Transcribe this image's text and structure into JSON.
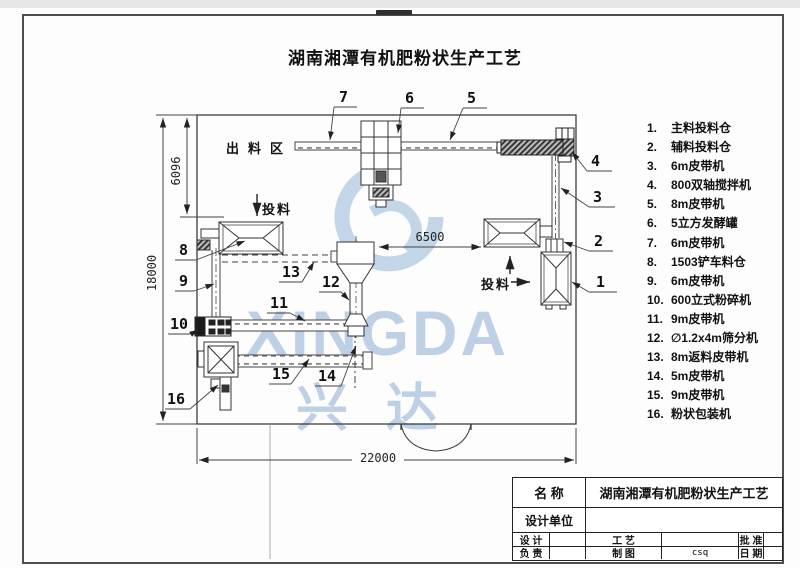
{
  "page": {
    "title": "湖南湘潭有机肥粉状生产工艺"
  },
  "drawing": {
    "area_label": "出料区",
    "feed_label_left": "投料",
    "feed_label_right": "投料",
    "dim_height_total": "18000",
    "dim_height_upper": "6096",
    "dim_width_total": "22000",
    "dim_mid_span": "6500",
    "callouts": [
      "1",
      "2",
      "3",
      "4",
      "5",
      "6",
      "7",
      "8",
      "9",
      "10",
      "11",
      "12",
      "13",
      "14",
      "15",
      "16"
    ]
  },
  "legend": {
    "items": [
      {
        "num": "1.",
        "label": "主料投料仓"
      },
      {
        "num": "2.",
        "label": "辅料投料仓"
      },
      {
        "num": "3.",
        "label": "6m皮带机"
      },
      {
        "num": "4.",
        "label": "800双轴搅拌机"
      },
      {
        "num": "5.",
        "label": "8m皮带机"
      },
      {
        "num": "6.",
        "label": "5立方发酵罐"
      },
      {
        "num": "7.",
        "label": "6m皮带机"
      },
      {
        "num": "8.",
        "label": "1503铲车料仓"
      },
      {
        "num": "9.",
        "label": "6m皮带机"
      },
      {
        "num": "10.",
        "label": "600立式粉碎机"
      },
      {
        "num": "11.",
        "label": "9m皮带机"
      },
      {
        "num": "12.",
        "label": "∅1.2x4m筛分机"
      },
      {
        "num": "13.",
        "label": "8m返料皮带机"
      },
      {
        "num": "14.",
        "label": "5m皮带机"
      },
      {
        "num": "15.",
        "label": "9m皮带机"
      },
      {
        "num": "16.",
        "label": "粉状包装机"
      }
    ]
  },
  "watermark": {
    "latin": "XINGDA",
    "cn": "兴达",
    "color": "#7fa3cd"
  },
  "title_block": {
    "name_label": "名 称",
    "name_value": "湖南湘潭有机肥粉状生产工艺",
    "unit_label": "设计单位",
    "design_label": "设 计",
    "lead_label": "负 责",
    "process_label": "工 艺",
    "draft_label": "制 图",
    "draft_value": "csq",
    "approve_label": "批 准",
    "date_label": "日 期"
  }
}
